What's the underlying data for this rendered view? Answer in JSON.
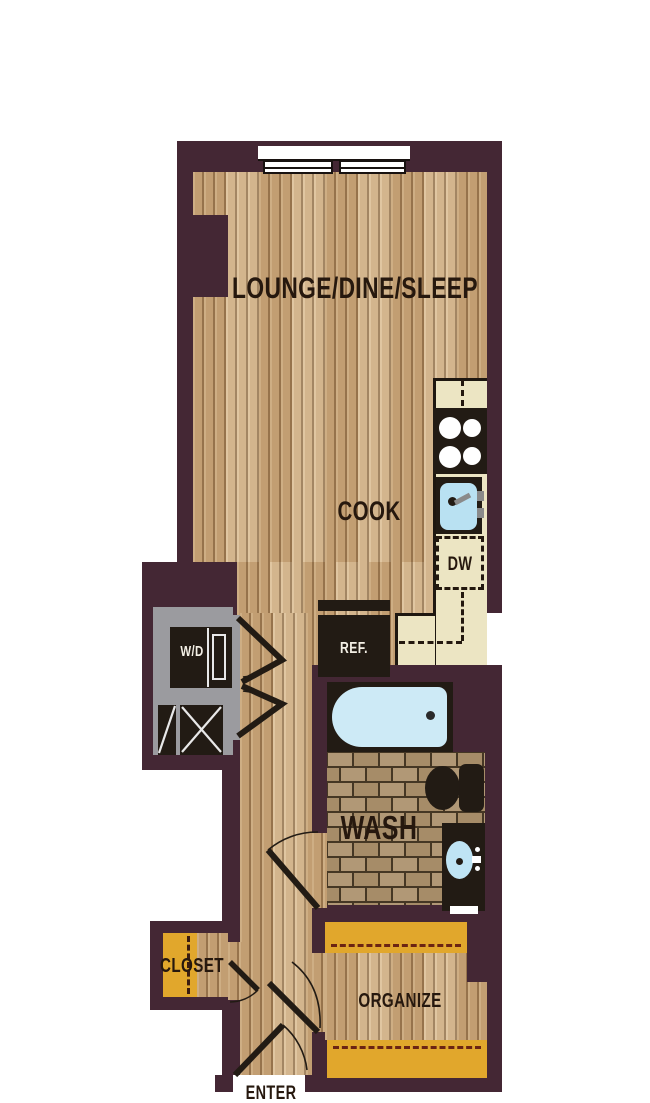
{
  "title": "Studio apartment floor plan",
  "labels": {
    "lounge": "LOUNGE/DINE/SLEEP",
    "cook": "COOK",
    "dishwasher": "DW",
    "refrigerator": "REF.",
    "washer_dryer": "W/D",
    "wash": "WASH",
    "closet": "CLOSET",
    "organize": "ORGANIZE",
    "enter": "ENTER"
  },
  "icons": [
    "window-icon",
    "stove-burners-icon",
    "kitchen-sink-icon",
    "dishwasher-icon",
    "refrigerator-icon",
    "washer-dryer-icon",
    "mechanical-unit-icon",
    "bathtub-icon",
    "toilet-icon",
    "vanity-sink-icon",
    "towel-bar-icon",
    "door-swing-icon",
    "bifold-door-icon",
    "closet-rod-icon",
    "shelf-icon"
  ],
  "colors": {
    "wall": "#442734",
    "wood_floor": "#c9a87e",
    "wood_grain": "#684828",
    "counter_cream": "#ece5c3",
    "appliance_black": "#221b14",
    "utility_gray": "#9b9b9f",
    "shelf_yellow": "#e1a72c",
    "tub_blue": "#cdeaf6",
    "sink_blue": "#b9e1f2",
    "tile_tan": "#ab9271",
    "tile_grout": "#453724",
    "label_dark": "#26180e",
    "label_light": "#f3efe5"
  }
}
